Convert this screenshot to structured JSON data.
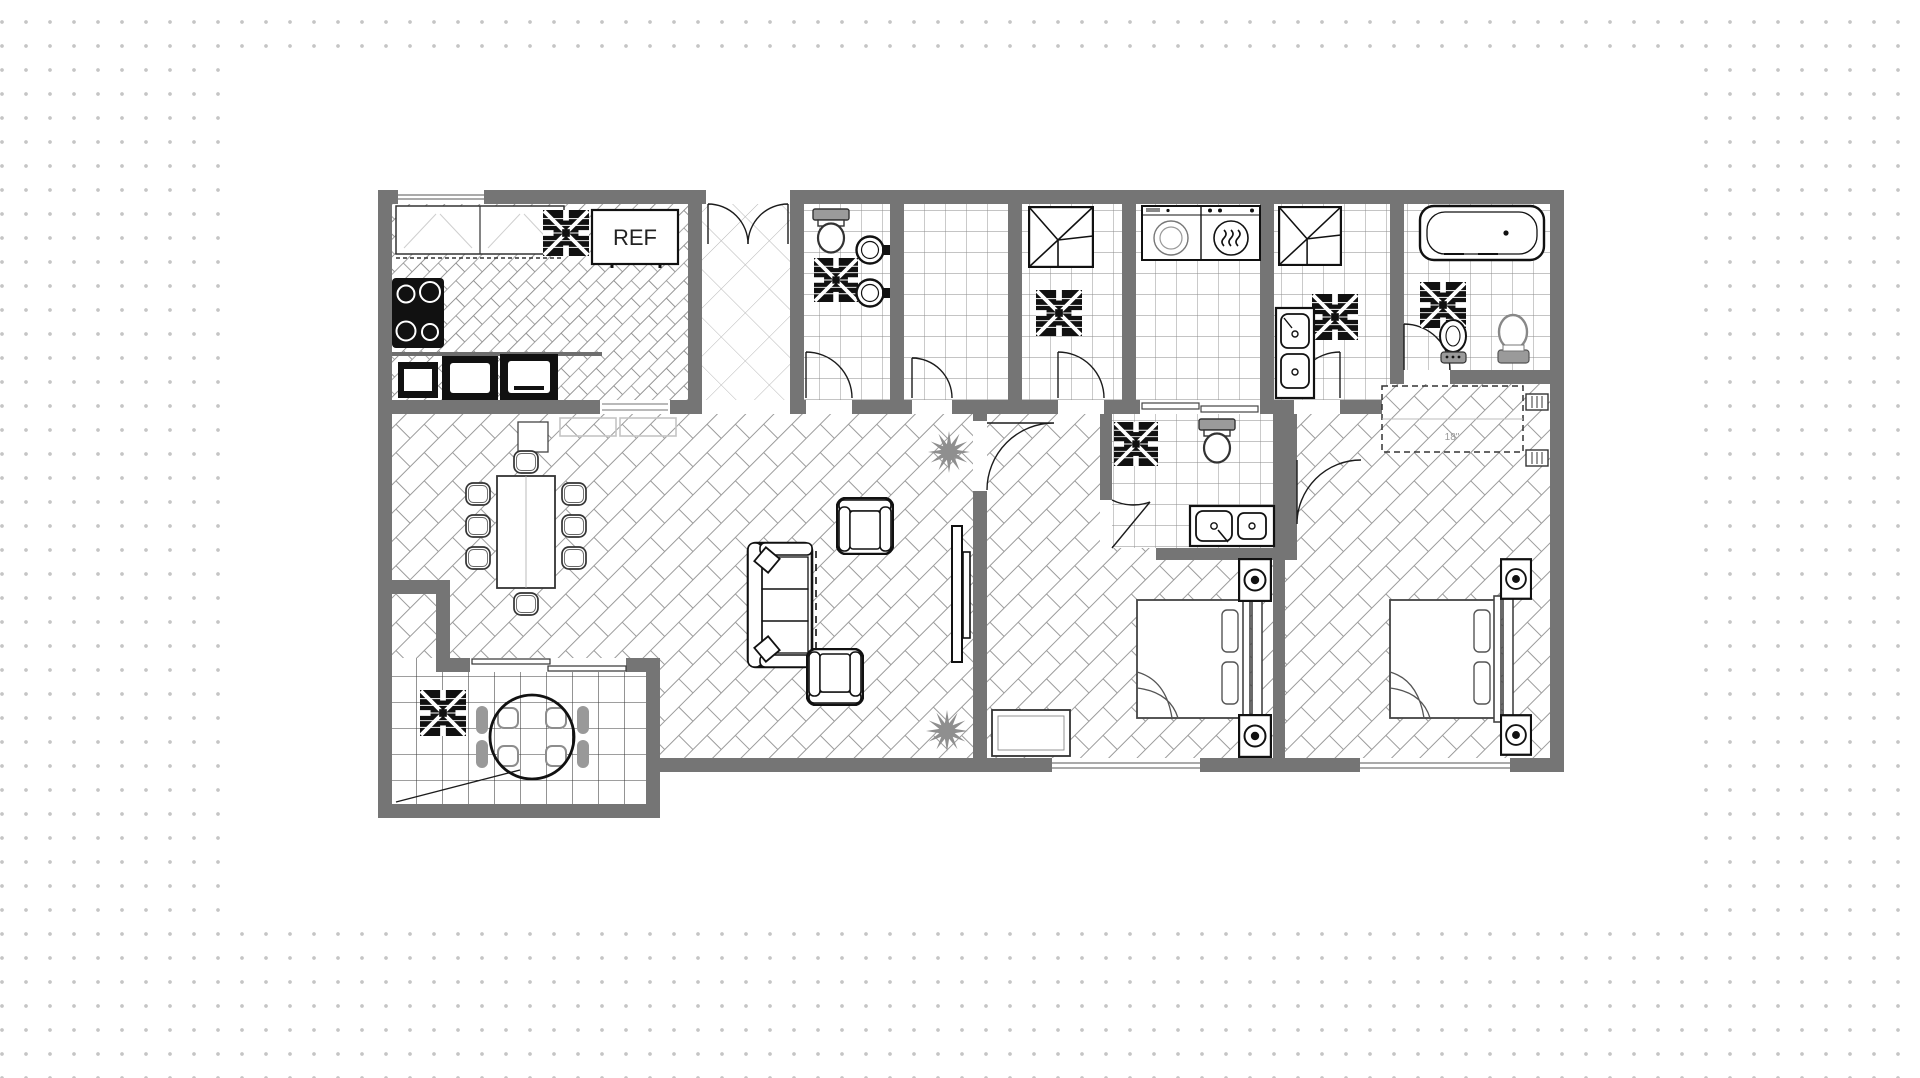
{
  "canvas": {
    "width": 1920,
    "height": 1078
  },
  "background": {
    "style": "dot-grid",
    "dot_color": "#c5c5c5",
    "page_color": "#ffffff"
  },
  "card": {
    "x": 232,
    "y": 66,
    "width": 1460,
    "height": 846,
    "color": "#ffffff"
  },
  "colors": {
    "wall": "#757575",
    "line": "#1c1c1c",
    "herringbone_line": "#9b9b9b",
    "tile_line": "#8a8a8a",
    "diamond_line": "#b7b7b7",
    "patio_grid_line": "#3c3c3c",
    "accent_gray": "#8f8f8f",
    "fixture_gray": "#999999",
    "white": "#ffffff"
  },
  "labels": {
    "refrigerator": "REF",
    "closet_width": "18\""
  },
  "floor_plan": {
    "type": "apartment-floor-plan",
    "rooms": [
      {
        "name": "kitchen",
        "floor": "herringbone-small",
        "fixtures": [
          "upper-cabinets",
          "ceiling-fan",
          "refrigerator",
          "stove",
          "microwave",
          "wall-ovens",
          "pass-through"
        ]
      },
      {
        "name": "entry-foyer",
        "floor": "diamond-lattice",
        "fixtures": [
          "double-entry-door"
        ]
      },
      {
        "name": "bathroom-1",
        "floor": "tile",
        "fixtures": [
          "toilet",
          "ceiling-fan",
          "round-sink",
          "round-sink",
          "door"
        ]
      },
      {
        "name": "water-closet",
        "floor": "tile",
        "fixtures": [
          "door"
        ]
      },
      {
        "name": "shower-room-a",
        "floor": "tile",
        "fixtures": [
          "shower-stall",
          "ceiling-fan",
          "door"
        ]
      },
      {
        "name": "laundry",
        "floor": "tile",
        "fixtures": [
          "washer",
          "dryer",
          "bifold-doors"
        ]
      },
      {
        "name": "shower-room-b",
        "floor": "tile",
        "fixtures": [
          "shower-stall",
          "double-basin-cabinet",
          "ceiling-fan",
          "door"
        ]
      },
      {
        "name": "main-bathroom",
        "floor": "tile",
        "fixtures": [
          "bathtub",
          "ceiling-fan",
          "bidet",
          "toilet",
          "door"
        ]
      },
      {
        "name": "dining-area",
        "floor": "herringbone",
        "fixtures": [
          "dining-table",
          "ten-chairs"
        ]
      },
      {
        "name": "living-room",
        "floor": "herringbone",
        "fixtures": [
          "sofa",
          "armchair",
          "armchair",
          "tv-panel",
          "plant",
          "plant"
        ]
      },
      {
        "name": "bedroom-1",
        "floor": "herringbone",
        "fixtures": [
          "double-bed",
          "nightstand-lamp",
          "nightstand-lamp",
          "dresser",
          "window",
          "door"
        ]
      },
      {
        "name": "bedroom-1-ensuite",
        "floor": "tile",
        "fixtures": [
          "toilet",
          "ceiling-fan",
          "double-sink-vanity",
          "door"
        ]
      },
      {
        "name": "bedroom-2",
        "floor": "herringbone",
        "fixtures": [
          "closet",
          "double-bed",
          "nightstand-lamp",
          "nightstand-lamp",
          "wall-sconce",
          "wall-sconce",
          "window",
          "door"
        ]
      },
      {
        "name": "patio",
        "floor": "grid-tile",
        "fixtures": [
          "round-table",
          "four-chairs",
          "ceiling-fan",
          "sliding-door"
        ]
      }
    ]
  }
}
